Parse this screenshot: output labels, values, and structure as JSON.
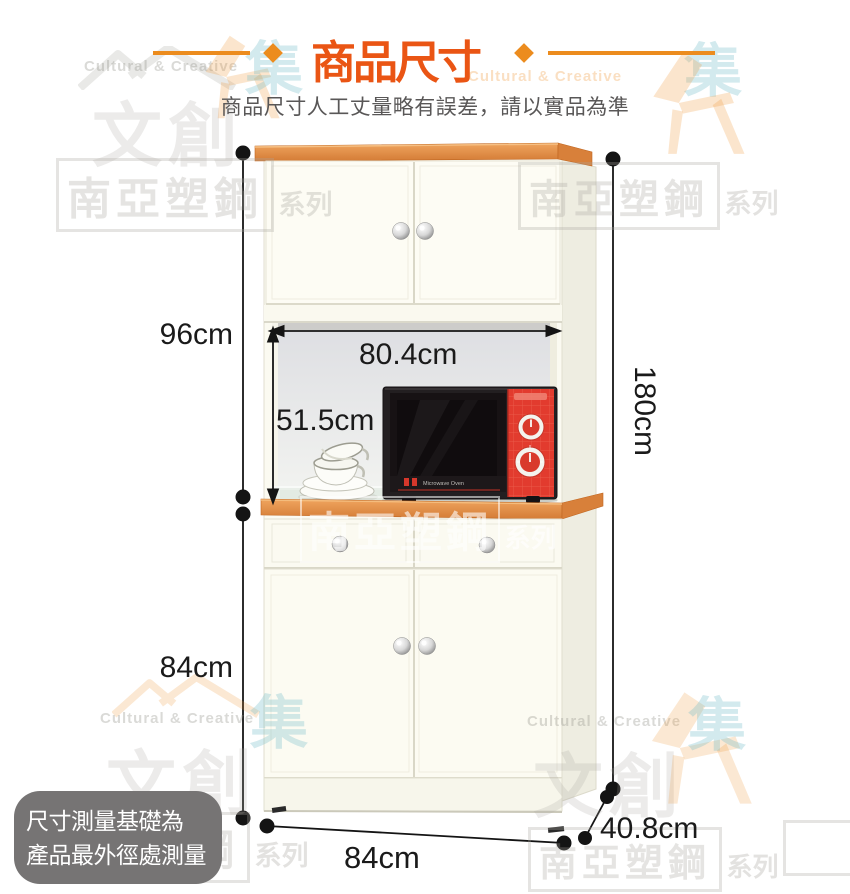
{
  "header": {
    "title": "商品尺寸",
    "subtitle": "商品尺寸人工丈量略有誤差，請以實品為準"
  },
  "dimensions": {
    "upper_height": "96cm",
    "inner_width": "80.4cm",
    "inner_height": "51.5cm",
    "total_height": "180cm",
    "lower_height": "84cm",
    "total_width": "84cm",
    "total_depth": "40.8cm"
  },
  "note": {
    "line1": "尺寸測量基礎為",
    "line2": "產品最外徑處測量"
  },
  "microwave": {
    "label": "Microwave Oven"
  },
  "watermark": {
    "brand_en": "Cultural & Creative",
    "brand_cn": "文創",
    "series_main": "南亞塑鋼",
    "series_suffix": "系列",
    "collect_cn": "集"
  },
  "colors": {
    "accent_title": "#EA5514",
    "accent_line": "#EC8C1E",
    "wood": "#E08B45",
    "cabinet_body": "#FBFAF1",
    "note_background": "#767474",
    "microwave_red": "#E23B2E",
    "dimension_ink": "#1A1A1A"
  }
}
